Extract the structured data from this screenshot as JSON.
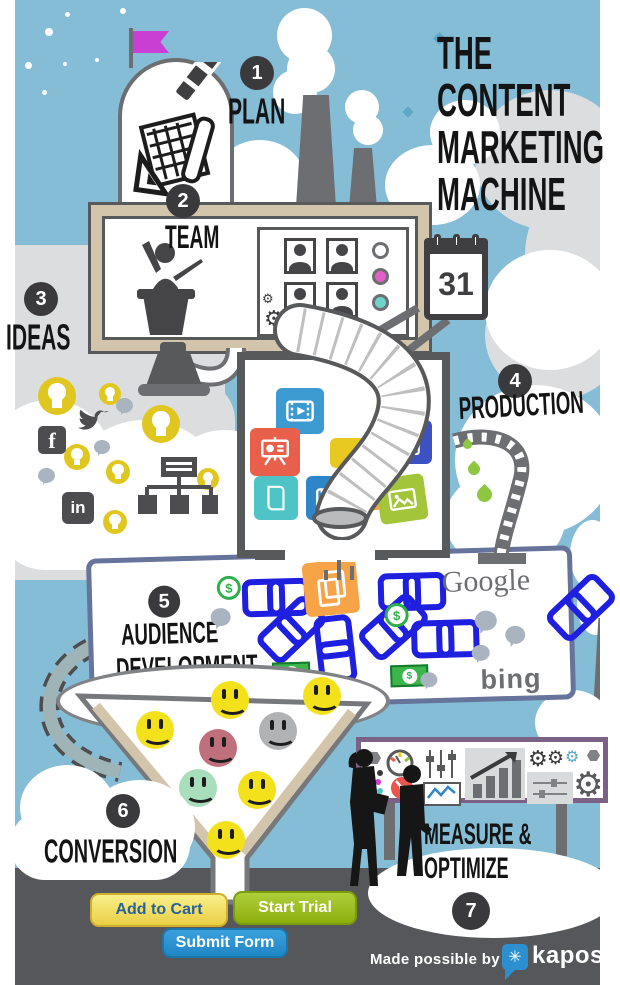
{
  "title": {
    "lines": [
      "THE",
      "CONTENT",
      "MARKETING",
      "MACHINE"
    ]
  },
  "steps": [
    {
      "num": "1",
      "label": "PLAN"
    },
    {
      "num": "2",
      "label": "TEAM"
    },
    {
      "num": "3",
      "label": "IDEAS"
    },
    {
      "num": "4",
      "label": "PRODUCTION"
    },
    {
      "num": "5",
      "lines": [
        "AUDIENCE",
        "DEVELOPMENT"
      ]
    },
    {
      "num": "6",
      "label": "CONVERSION"
    },
    {
      "num": "7",
      "lines": [
        "MEASURE &",
        "OPTIMIZE"
      ]
    }
  ],
  "calendar": {
    "day": "31"
  },
  "board": {
    "google": "Google",
    "bing": "bing"
  },
  "social": {
    "facebook": "f",
    "linkedin": "in"
  },
  "money": {
    "dollar": "$"
  },
  "buttons": [
    {
      "label": "Add to Cart"
    },
    {
      "label": "Start Trial"
    },
    {
      "label": "Submit Form"
    }
  ],
  "footer": {
    "credit": "Made possible by",
    "brand": "kapost"
  },
  "icons": {
    "gear": "⚙",
    "star": "✳"
  },
  "colors": {
    "sky": "#85bcd6",
    "cloud_gray": "#dcdddf",
    "dark_band": "#56575a",
    "badge": "#3a3a3c",
    "frame_tan": "#d3c4ac",
    "flag_magenta": "#c93fd4",
    "bulb_yellow": "#e0c71f",
    "chain_blue": "#1f1fe0",
    "money_green": "#2faf4a",
    "drop_green": "#8dc63f",
    "board_border": "#66739a",
    "billboard_border": "#7b6185",
    "kapost_blue": "#2b8fd0",
    "btn_yellow": "#ecd84e",
    "btn_green": "#96bd12",
    "btn_blue": "#2491d1"
  }
}
